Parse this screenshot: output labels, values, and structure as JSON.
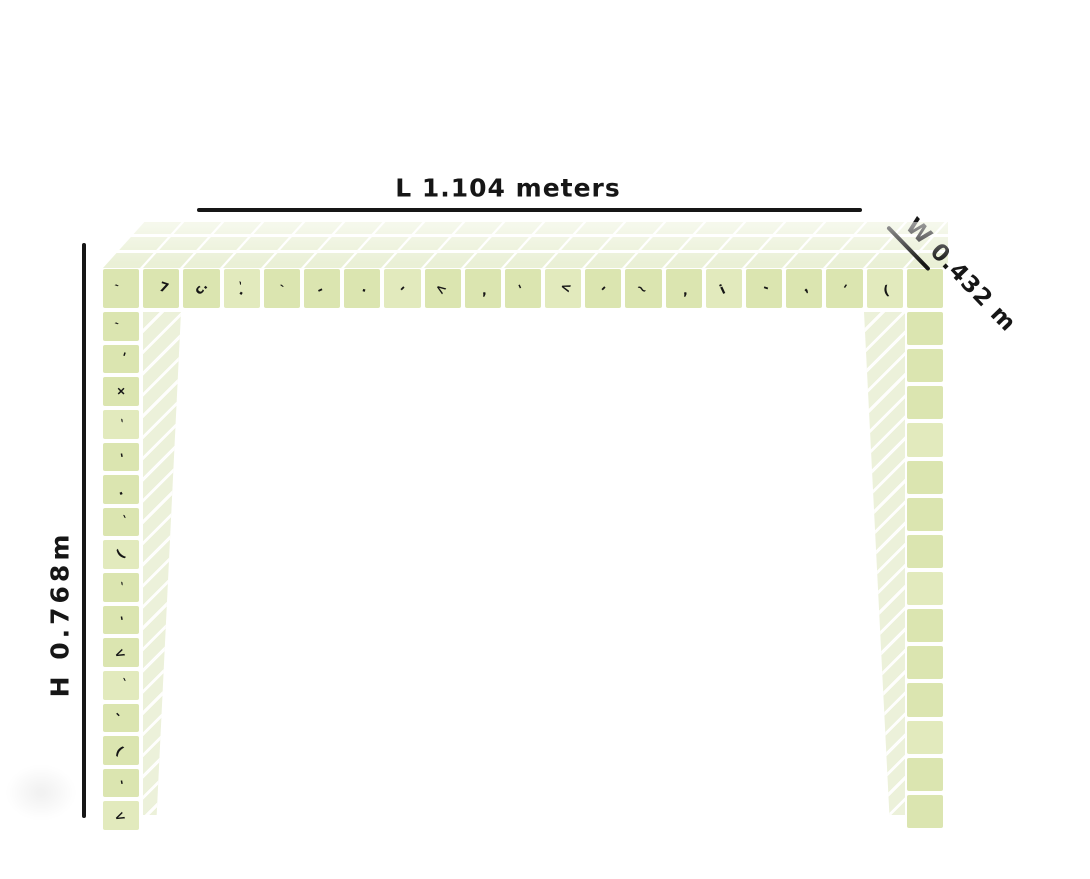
{
  "sketch": {
    "subject": "tiled console table dimension sketch",
    "dimensions": {
      "length_label": "L 1.104 meters",
      "width_label": "W 0.432 m",
      "height_label": "H 0.768m",
      "length_m": 1.104,
      "width_m": 0.432,
      "height_m": 0.768
    }
  },
  "table": {
    "top_columns": 21,
    "top_rows": 3,
    "apron_tiles": 21,
    "apron_marks": [
      "`",
      "7",
      "c.",
      "`.",
      "`",
      "-",
      ".",
      "-",
      "<",
      ",",
      "'",
      "<",
      "-",
      "~",
      ",",
      "i",
      "-",
      ",",
      "'",
      "(",
      ""
    ],
    "left_leg_tiles": 16,
    "left_leg_marks": [
      "`",
      "'",
      "+",
      "`",
      "'",
      ".",
      "`",
      "(",
      "`",
      "'",
      "<",
      "`",
      "'",
      "(",
      "'",
      "<"
    ],
    "right_leg_tiles": 14,
    "right_leg_marks": []
  },
  "colors": {
    "ink": "#161616",
    "tile_bright": "#dbe5b0",
    "tile_bright2": "#e2eabd",
    "tile_top": "#eaf0d6",
    "hatch": "#ecf1da",
    "background": "#ffffff"
  }
}
